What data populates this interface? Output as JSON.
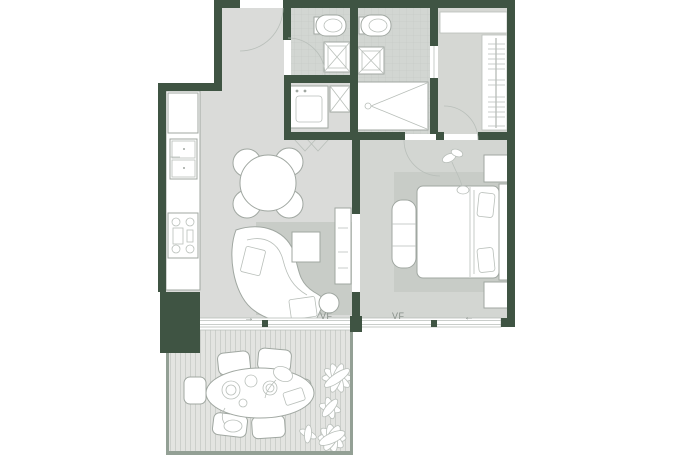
{
  "page": {
    "title": "apartment-floor-plan"
  },
  "labels": {
    "vf_living": "VF",
    "vf_bedroom": "VF",
    "arrow_living": "→",
    "arrow_bedroom": "←"
  },
  "colors": {
    "wall": "#3f5443",
    "floor_main": "#dadbd9",
    "floor_bedroom": "#d3d6d2",
    "floor_bath": "#d2d6d2",
    "tile_line": "#c3c8c4",
    "floor_closet": "#d5d7d3",
    "rug": "#c8ccc7",
    "deck": "#e3e4e1",
    "deck_stripe": "#cccfcb",
    "line": "#a0a7a1",
    "line_soft": "#b9bfba",
    "fixture": "#ffffff",
    "label_text": "#868e88",
    "railing": "#93a095",
    "background": "#ffffff"
  }
}
